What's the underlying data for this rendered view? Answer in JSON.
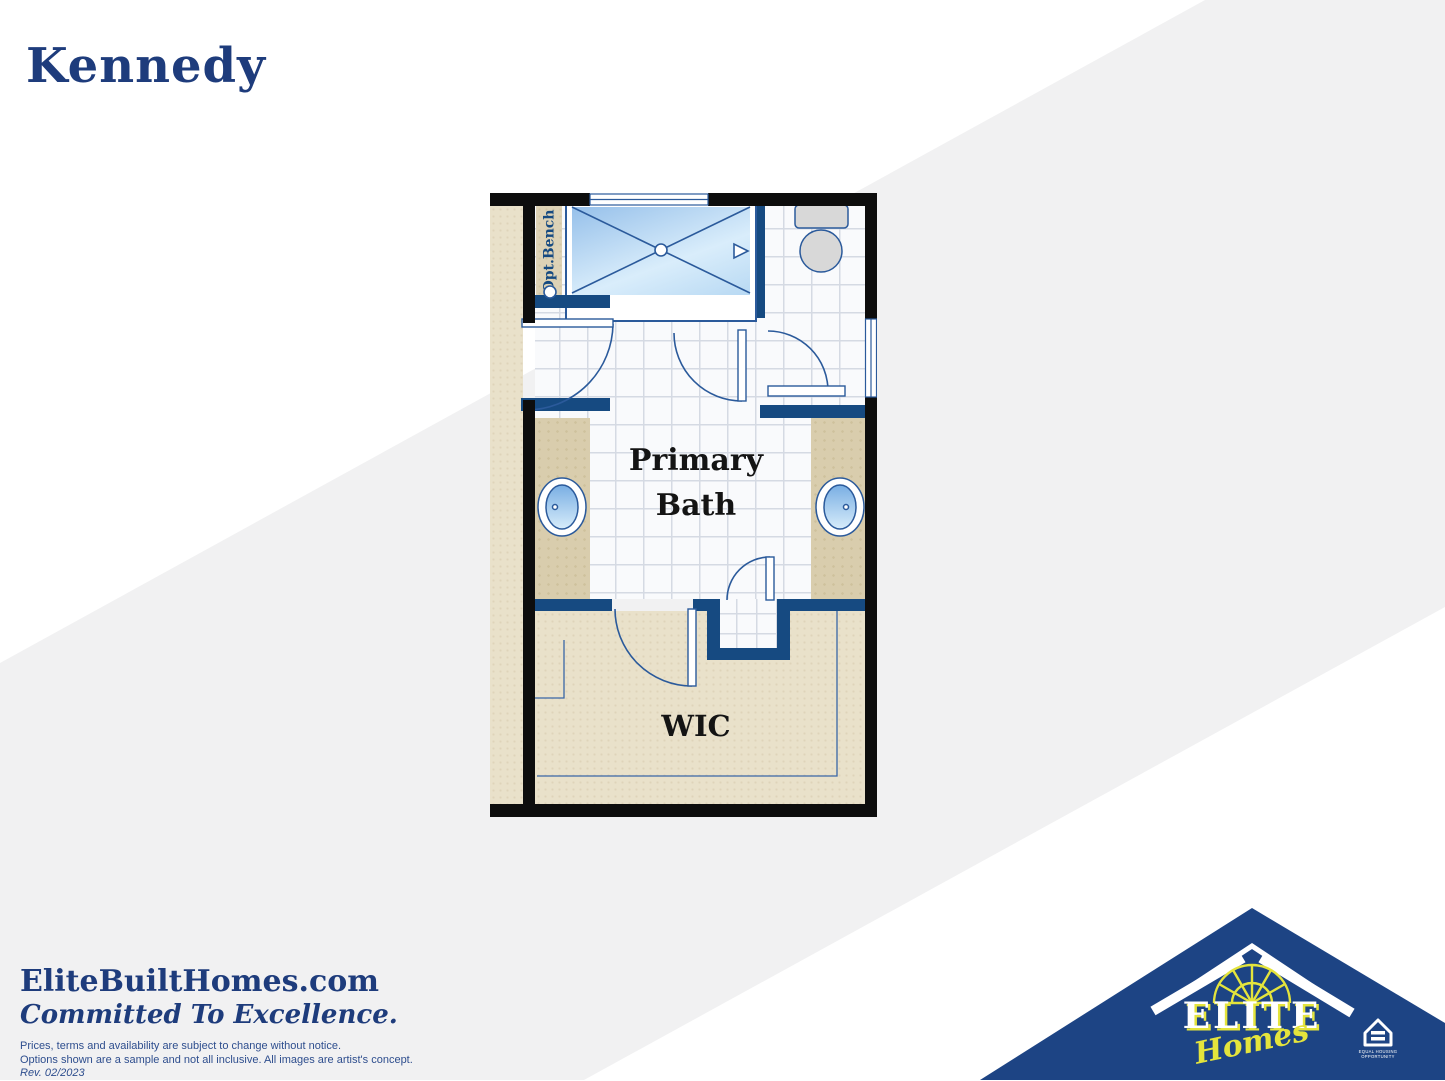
{
  "title": "Kennedy",
  "floor_plan": {
    "primary_bath_line1": "Primary",
    "primary_bath_line2": "Bath",
    "wic_label": "WIC",
    "bench_label": "Opt.Bench"
  },
  "footer": {
    "website": "EliteBuiltHomes.com",
    "tagline": "Committed To Excellence.",
    "disclaimer1": "Prices, terms and availability are subject to change without notice.",
    "disclaimer2": "Options shown are a sample and not all inclusive. All images are artist's concept.",
    "revision": "Rev. 02/2023"
  },
  "logo": {
    "brand": "ELITE",
    "brand_script": "Homes",
    "eho_line1": "EQUAL HOUSING",
    "eho_line2": "OPPORTUNITY"
  },
  "colors": {
    "headline_navy": "#1e3c7c",
    "plan_wall_navy": "#164a81",
    "plan_line_blue": "#2b5a9b",
    "house_logo_blue": "#1d4484",
    "logo_yellow": "#e4e43c",
    "gray_band": "#f1f1f2",
    "floor_tan": "#e9e1ca",
    "counter_tan": "#d9cdad",
    "shower_blue": "#96c0ea"
  }
}
